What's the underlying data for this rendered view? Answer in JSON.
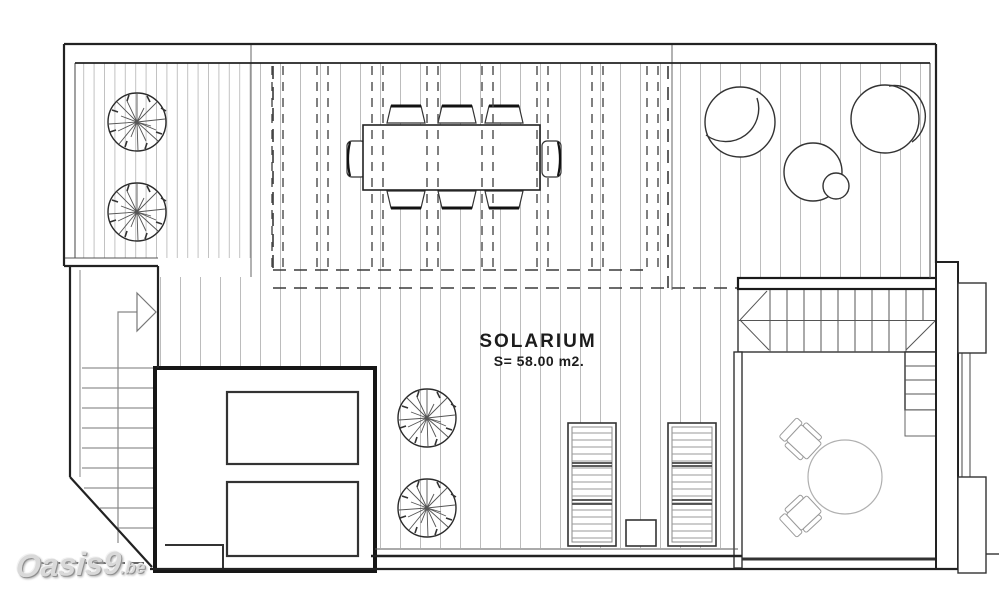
{
  "labels": {
    "room_name": "SOLARIUM",
    "room_area": "S= 58.00 m2."
  },
  "watermark": {
    "brand": "Oasis9",
    "suffix": ".be"
  },
  "colors": {
    "background": "#ffffff",
    "line_dark": "#222222",
    "line_medium": "#555555",
    "line_light": "#999999",
    "deck_board": "#bcbcbc",
    "watermark_fill": "#d9d9d9"
  }
}
